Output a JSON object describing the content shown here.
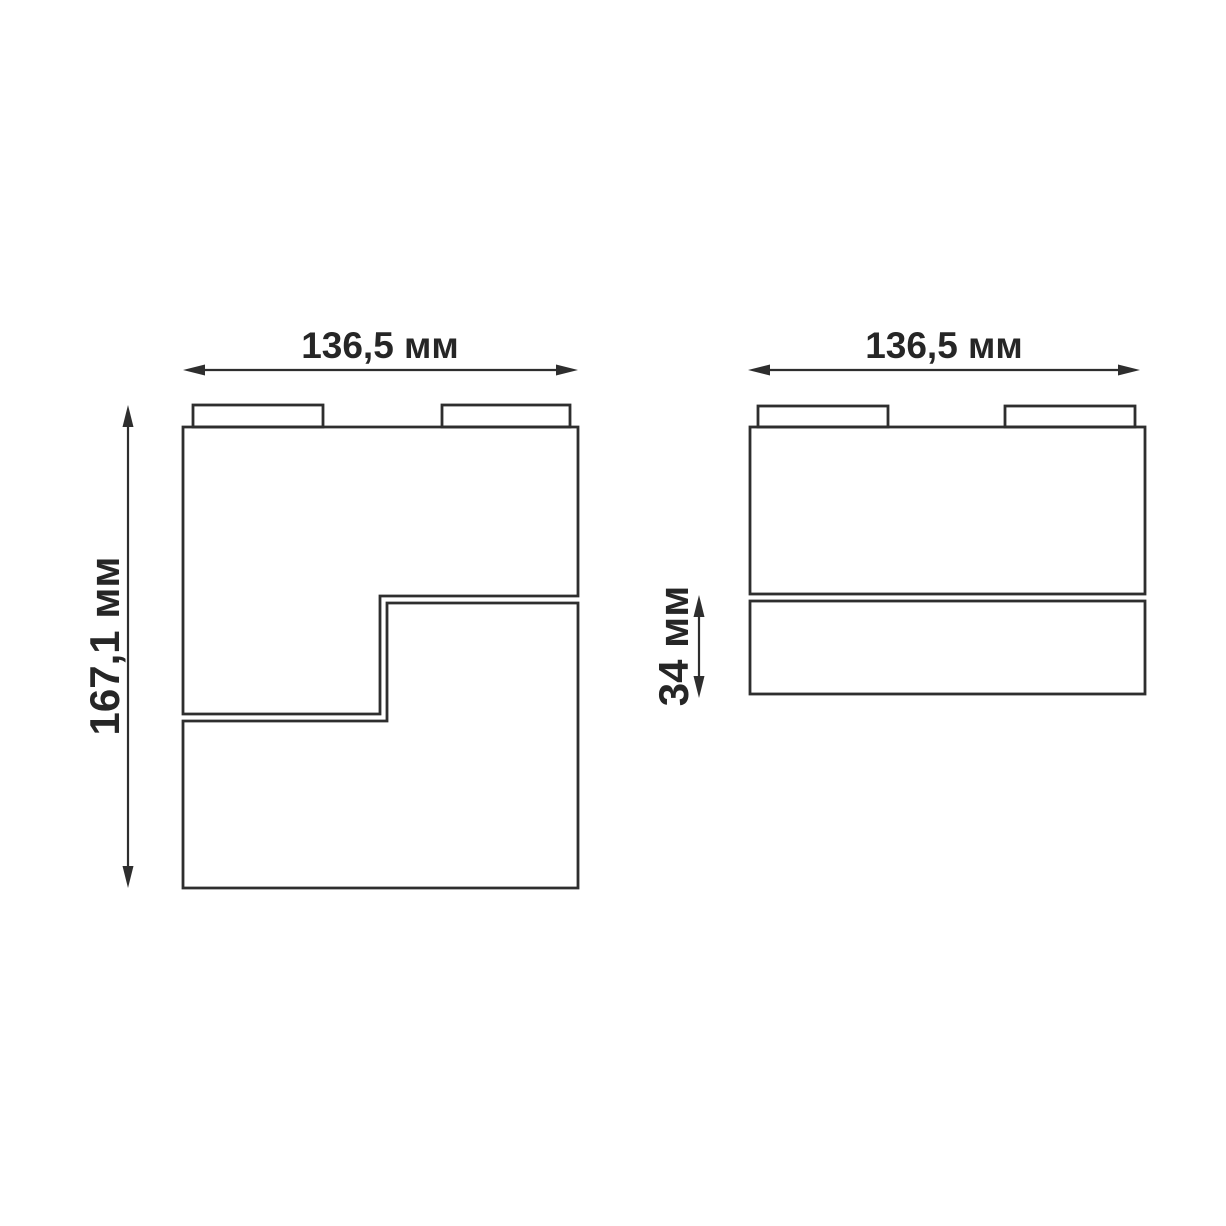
{
  "front_view": {
    "width_label": "136,5 мм",
    "height_label": "167,1 мм"
  },
  "side_view": {
    "width_label": "136,5 мм",
    "depth_label": "34 мм"
  },
  "colors": {
    "line": "#2e2e2e",
    "text": "#262626",
    "background": "#ffffff"
  }
}
